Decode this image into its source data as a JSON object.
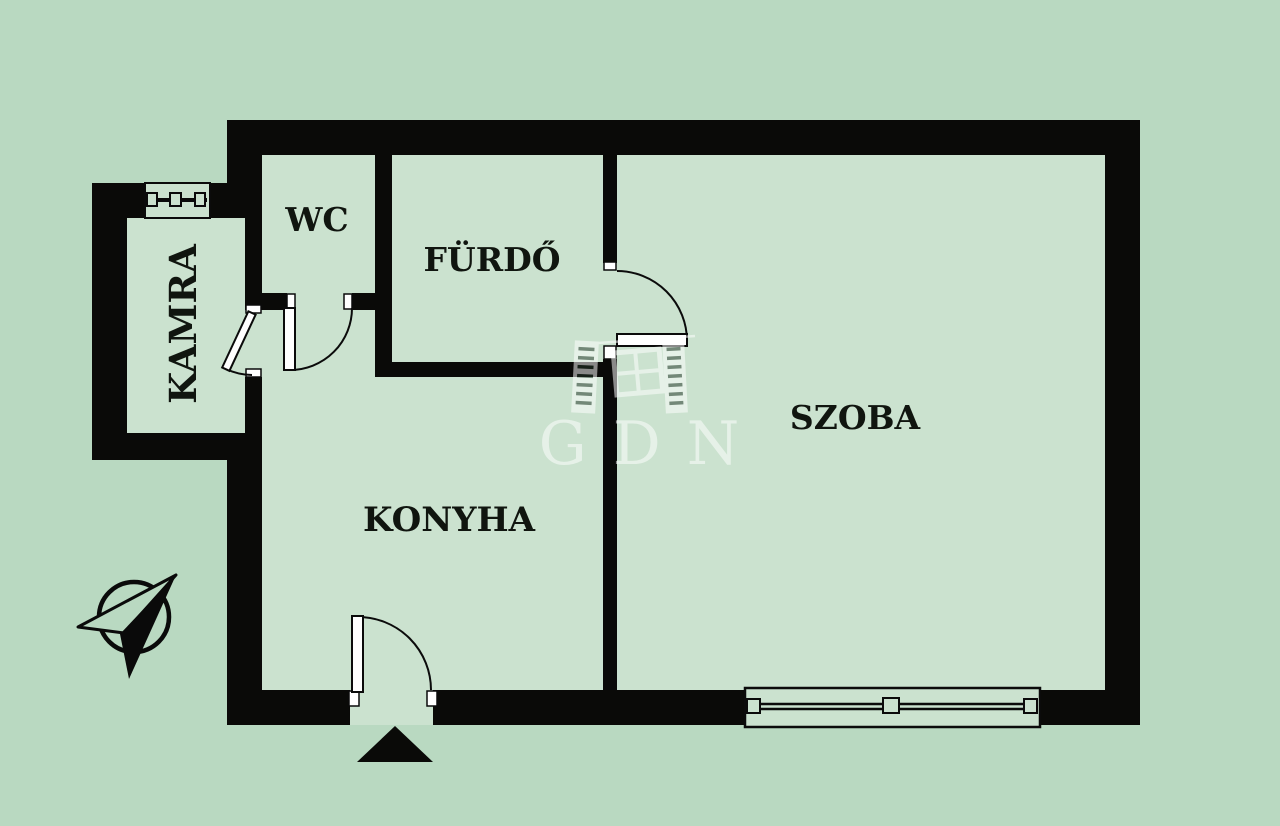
{
  "title": "Apartment floor plan",
  "colors": {
    "background": "#b9d9c1",
    "room_fill": "#cbe2cf",
    "wall": "#0a0a08",
    "label": "#10150f",
    "door_leaf_fill": "#ffffff",
    "watermark_white": "#ffffff"
  },
  "rooms": [
    {
      "id": "kamra",
      "label": "KAMRA"
    },
    {
      "id": "wc",
      "label": "WC"
    },
    {
      "id": "furdo",
      "label": "FÜRDŐ"
    },
    {
      "id": "konyha",
      "label": "KONYHA"
    },
    {
      "id": "szoba",
      "label": "SZOBA"
    }
  ],
  "watermark": {
    "text": "GDN",
    "logo": "gdn-building-logo"
  },
  "symbols": {
    "north_arrow": "compass-north-arrow",
    "entrance_marker": "entrance-arrow-triangle",
    "window": "window-symbol",
    "door": "door-swing-symbol"
  }
}
